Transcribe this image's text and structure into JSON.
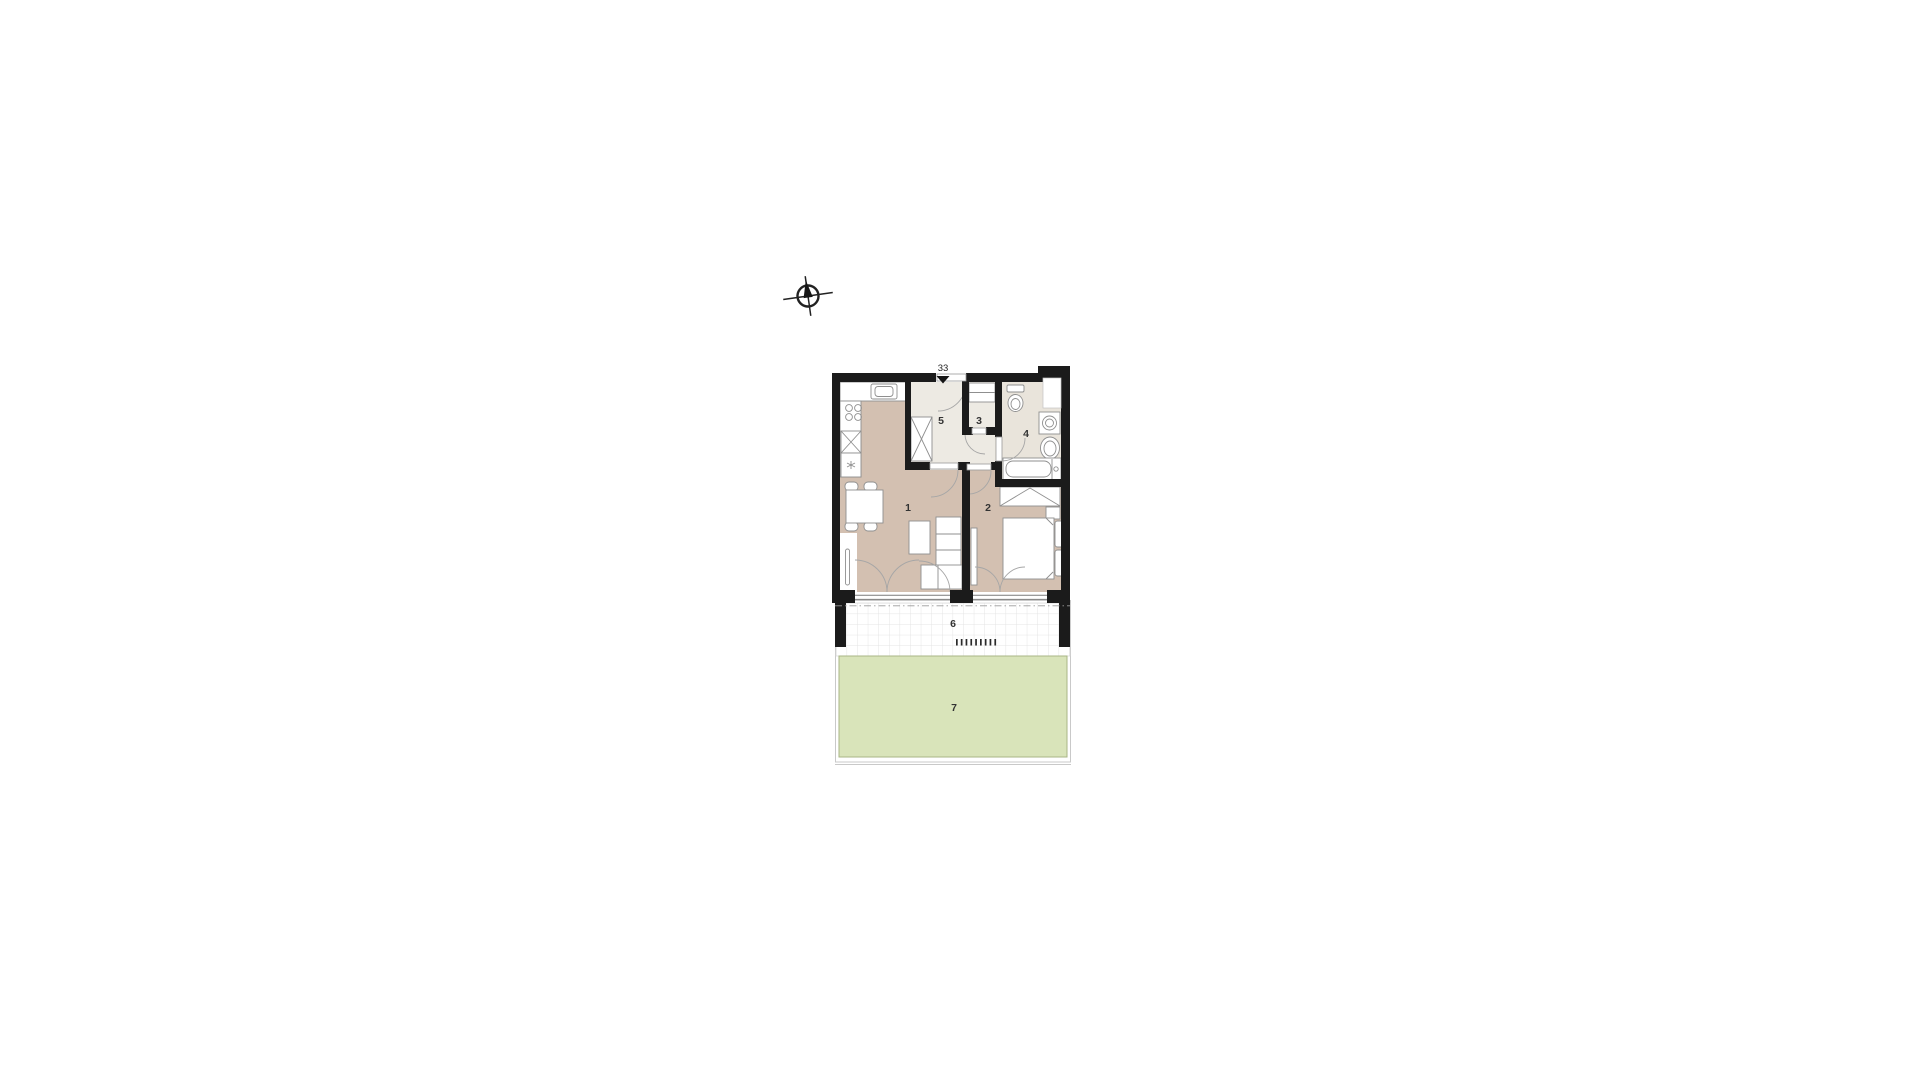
{
  "plan": {
    "unit_number": "33",
    "room_labels": {
      "room_1": "1",
      "room_2": "2",
      "room_3": "3",
      "room_4": "4",
      "room_5": "5",
      "room_6": "6",
      "room_7": "7"
    },
    "icons": {
      "compass": "compass-rose-icon",
      "entry_arrow": "entry-direction-arrow-icon"
    },
    "colors": {
      "background": "#ffffff",
      "wall": "#1b1b1b",
      "floor_main": "#d3c0b1",
      "floor_hall": "#edeae3",
      "floor_bath": "#e9e4db",
      "garden_fill": "#d9e4ba",
      "garden_border": "#a9b685",
      "terrace_grid": "#e4e4e4",
      "label_text": "#333333"
    }
  }
}
